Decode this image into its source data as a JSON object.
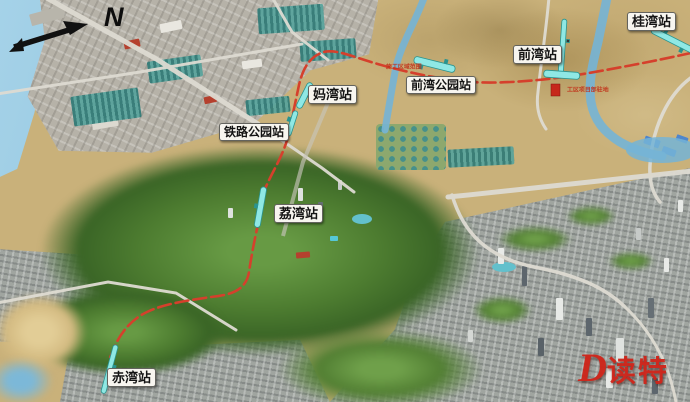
{
  "compass": {
    "label": "N"
  },
  "stations": [
    {
      "id": "guiwan",
      "name": "桂湾站"
    },
    {
      "id": "qianwan",
      "name": "前湾站"
    },
    {
      "id": "qianwan-park",
      "name": "前湾公园站"
    },
    {
      "id": "mawan",
      "name": "妈湾站"
    },
    {
      "id": "railway-park",
      "name": "铁路公园站"
    },
    {
      "id": "liwan",
      "name": "荔湾站"
    },
    {
      "id": "chiwan",
      "name": "赤湾站"
    }
  ],
  "notes": [
    {
      "text": "施工区域范围"
    },
    {
      "text": "工区项目部驻地"
    }
  ],
  "watermark": {
    "d": "D",
    "name": "读特"
  },
  "colors": {
    "metro_line": "#d5402c",
    "station_marker": "#8fe8e4",
    "station_marker_border": "#2a948f",
    "label_bg": "#f7f5ef",
    "annotation_red": "#c23018",
    "water": "#7cb8d8"
  }
}
